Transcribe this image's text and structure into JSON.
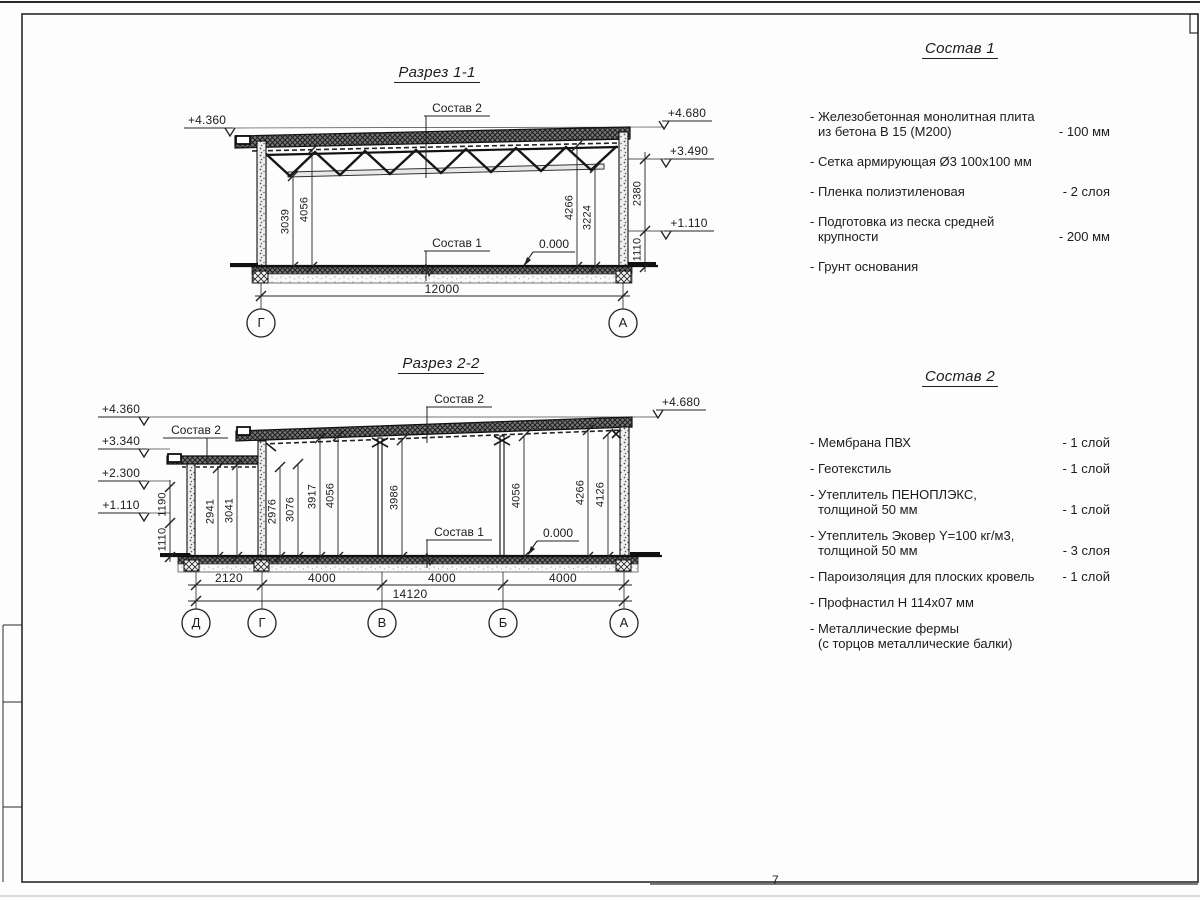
{
  "frame": {
    "page_number": "7"
  },
  "section1": {
    "title": "Разрез 1-1",
    "labels": {
      "sostav2": "Состав 2",
      "sostav1": "Состав 1",
      "zero": "0.000"
    },
    "elevations": {
      "left_top": "+4.360",
      "right_top": "+4.680",
      "right_mid": "+3.490",
      "right_low": "+1.110"
    },
    "dims": {
      "inner": [
        "3039",
        "4056",
        "4266",
        "3224"
      ],
      "right": [
        "2380",
        "1110"
      ],
      "bottom": "12000"
    },
    "axes": [
      "Г",
      "А"
    ]
  },
  "section2": {
    "title": "Разрез 2-2",
    "labels": {
      "sostav2_top": "Состав 2",
      "sostav2_left": "Состав 2",
      "sostav1": "Состав 1",
      "zero": "0.000"
    },
    "elevations": {
      "left": [
        "+4.360",
        "+3.340",
        "+2.300",
        "+1.110"
      ],
      "right_top": "+4.680"
    },
    "dims": {
      "left_outer": [
        "1190",
        "1110"
      ],
      "inner": [
        "2941",
        "3041",
        "2976",
        "3076",
        "3917",
        "4056",
        "3986",
        "4056",
        "4266",
        "4126"
      ],
      "bottom": [
        "2120",
        "4000",
        "4000",
        "4000"
      ],
      "total": "14120"
    },
    "axes": [
      "Д",
      "Г",
      "В",
      "Б",
      "А"
    ]
  },
  "sostav1_panel": {
    "title": "Состав 1",
    "items": [
      {
        "line1": "- Железобетонная  монолитная плита",
        "line2": "из бетона В 15 (М200)",
        "value": "- 100 мм"
      },
      {
        "line1": "- Сетка армирующая Ø3 100х100 мм",
        "line2": "",
        "value": ""
      },
      {
        "line1": "- Пленка полиэтиленовая",
        "line2": "",
        "value": "-  2 слоя"
      },
      {
        "line1": "- Подготовка из песка средней",
        "line2": "крупности",
        "value": "- 200 мм"
      },
      {
        "line1": "- Грунт основания",
        "line2": "",
        "value": ""
      }
    ]
  },
  "sostav2_panel": {
    "title": "Состав 2",
    "items": [
      {
        "line1": "- Мембрана ПВХ",
        "line2": "",
        "value": "- 1 слой"
      },
      {
        "line1": "- Геотекстиль",
        "line2": "",
        "value": "- 1 слой"
      },
      {
        "line1": "- Утеплитель ПЕНОПЛЭКС,",
        "line2": "толщиной 50 мм",
        "value": "- 1 слой"
      },
      {
        "line1": "- Утеплитель Эковер Y=100 кг/м3,",
        "line2": "толщиной 50 мм",
        "value": "- 3 слоя"
      },
      {
        "line1": "- Пароизоляция для плоских кровель",
        "line2": "",
        "value": "- 1 слой"
      },
      {
        "line1": "- Профнастил Н 114х07 мм",
        "line2": "",
        "value": ""
      },
      {
        "line1": "- Металлические фермы",
        "line2": "(с торцов металлические балки)",
        "value": ""
      }
    ]
  }
}
